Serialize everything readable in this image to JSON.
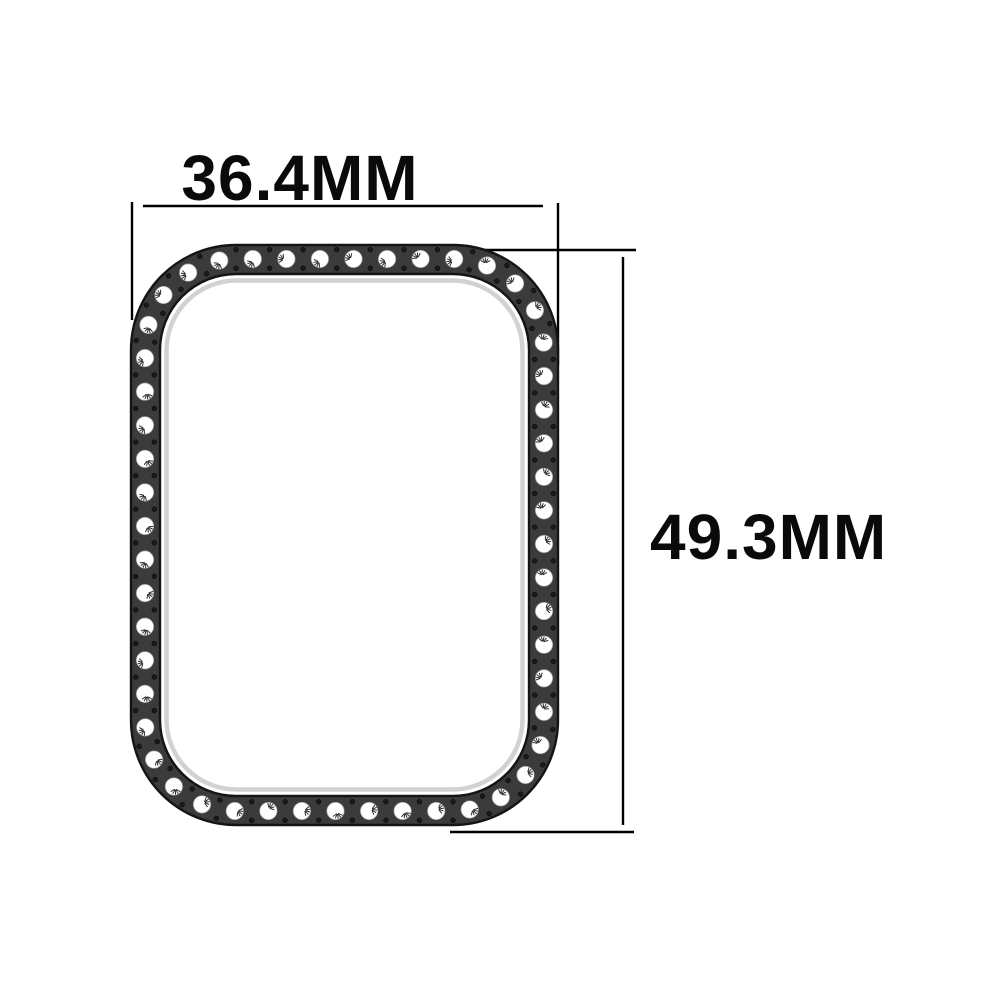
{
  "diagram": {
    "title_hint": "smartwatch-protective-case-dimensions",
    "width_label": "36.4MM",
    "height_label": "49.3MM",
    "colors": {
      "background": "#ffffff",
      "band_fill": "#3b3b3d",
      "band_outline": "#141414",
      "stone_fill": "#ffffff",
      "stone_edge": "#9e9e9e",
      "stone_mark": "#2e2e2e",
      "dot_fill": "#1a1a1a",
      "inner_shadow": "#d2d2d2",
      "dimension_line": "#000000",
      "label_text": "#0a0a0a"
    }
  }
}
